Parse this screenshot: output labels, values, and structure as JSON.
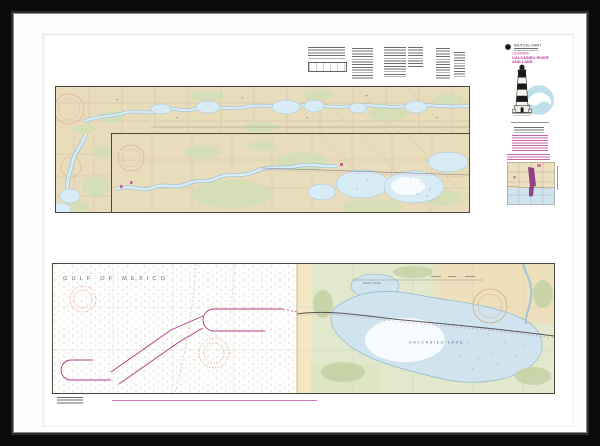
{
  "header": {
    "agency": "NAUTICAL CHART",
    "region": "LOUISIANA",
    "title_line1": "CALCASIEU RIVER",
    "title_line2": "AND LAKE"
  },
  "map_labels": {
    "gulf": "GULF OF MEXICO",
    "lake": "CALCASIEU LAKE",
    "west_cove": "WEST COVE"
  },
  "icons": {
    "noaa_seal": "noaa-seal-icon",
    "noaa_logo": "noaa-logo-icon",
    "lighthouse": "lighthouse-icon",
    "compass_rose": "compass-rose-icon",
    "coverage_inset": "coverage-inset-map"
  },
  "colors": {
    "frame": "#0b0b0b",
    "matte": "#fefefe",
    "land_beige": "#e9dcbb",
    "water_blue": "#d8ecf5",
    "marsh_green": "#d3dfb5",
    "title_magenta": "#b5338f",
    "channel_magenta": "#b23a86",
    "noaa_blue": "#bfdfeb",
    "compass_pink": "#dfae9f"
  }
}
